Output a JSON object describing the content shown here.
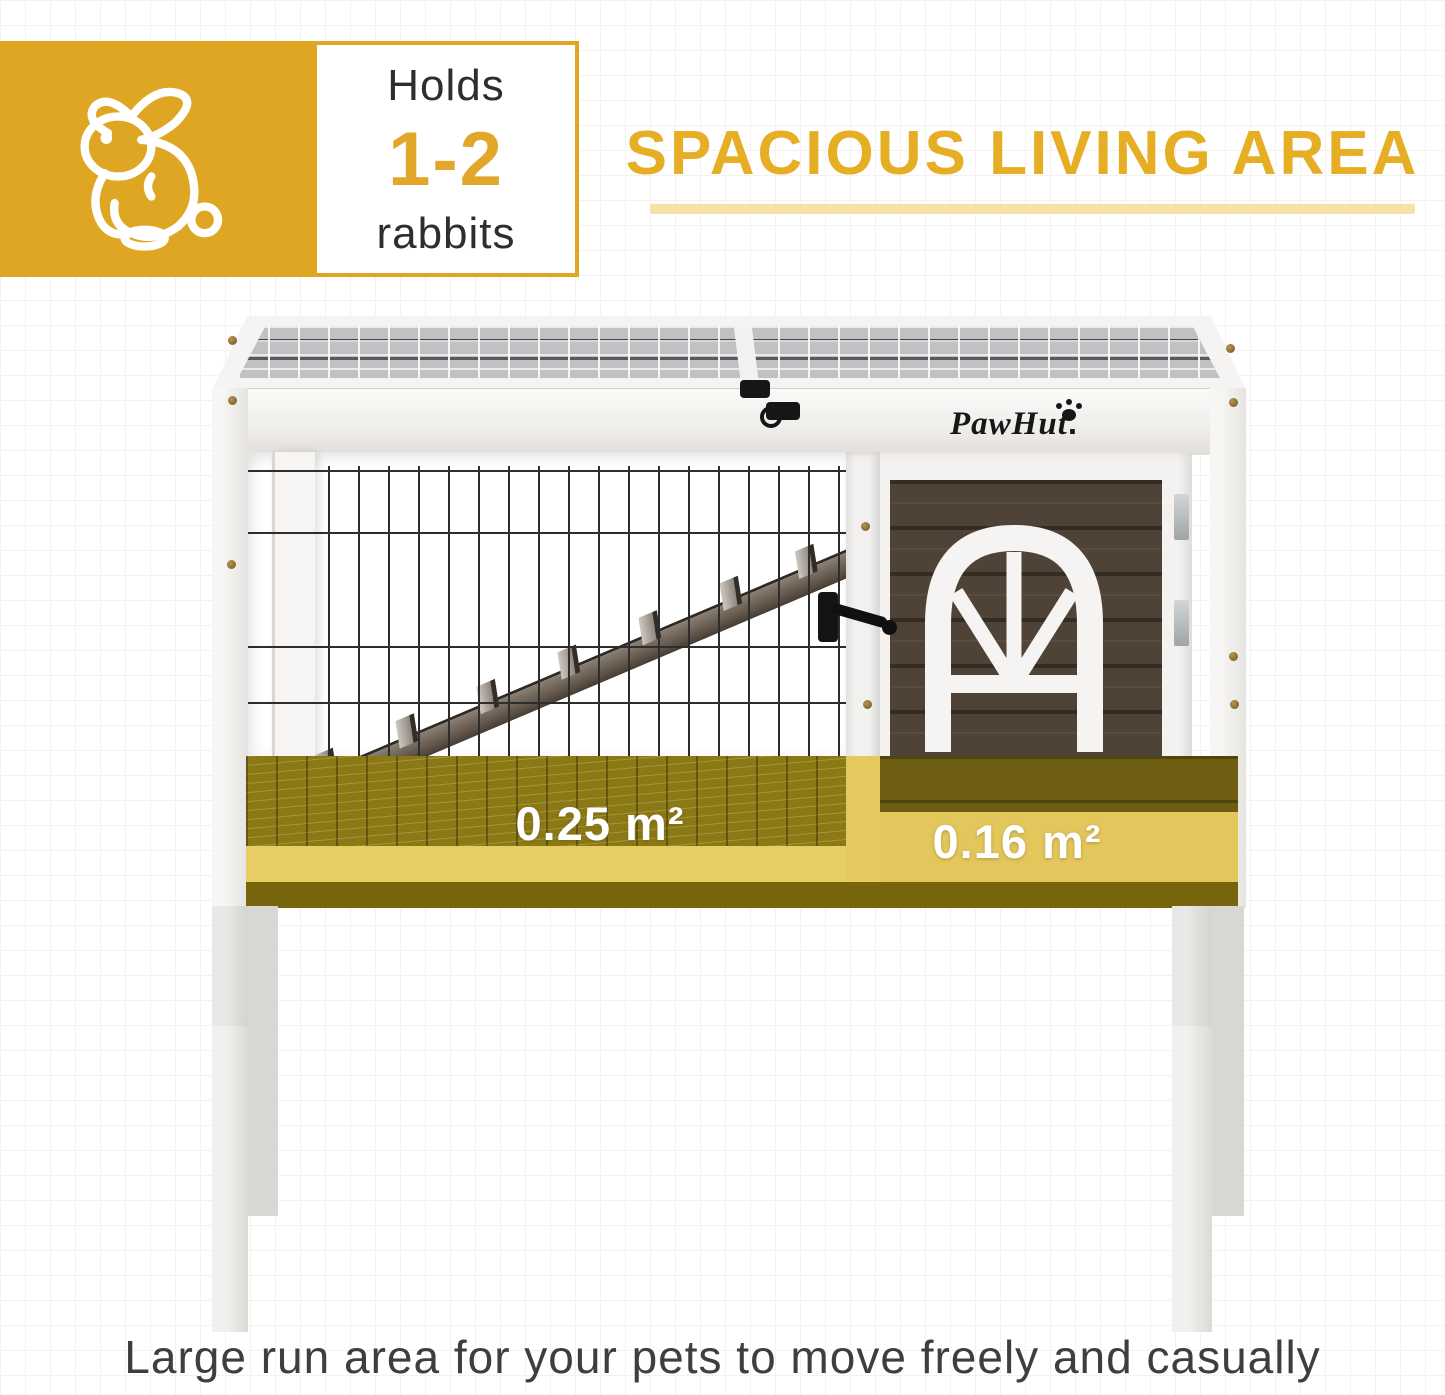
{
  "capacity_badge": {
    "holds_label": "Holds",
    "capacity_value": "1-2",
    "capacity_unit": "rabbits",
    "rabbit_icon": "rabbit-line-icon"
  },
  "heading": {
    "title": "SPACIOUS LIVING AREA"
  },
  "hutch": {
    "brand_logo": "PawHut",
    "brand_logo_dot": ".",
    "paw_icon": "paw-print-icon",
    "run_area_label": "0.25 m²",
    "house_area_label": "0.16 m²"
  },
  "caption": "Large run area for your pets to move freely and casually",
  "colors": {
    "brand_gold": "#DFA624",
    "heading_gold": "#E5AE24",
    "underline_gold": "#F5E2A9",
    "area_overlay_gold": "#C9A81C",
    "area_label_text": "#FFFFFF",
    "caption_text": "#3E3E3E",
    "door_wood_brown": "#4F4337",
    "hutch_white": "#F3F2F0"
  }
}
